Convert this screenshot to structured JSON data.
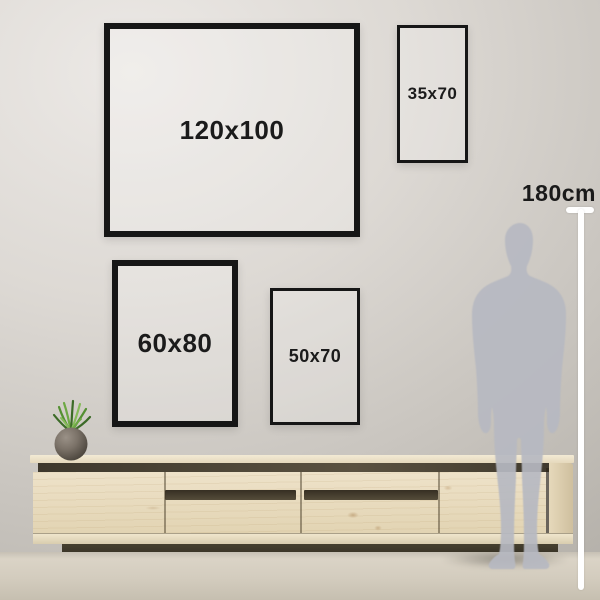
{
  "scene": {
    "description": "wall-art size comparison guide",
    "frames": [
      {
        "label": "120x100"
      },
      {
        "label": "35x70"
      },
      {
        "label": "60x80"
      },
      {
        "label": "50x70"
      }
    ],
    "measurement": {
      "height_label": "180cm"
    },
    "icons": {
      "person": "person-silhouette",
      "measure": "height-measure-line",
      "plant": "potted-plant",
      "furniture": "wooden-sideboard"
    },
    "colors": {
      "frame_border": "#161616",
      "label_text": "#1b1b1b",
      "wall_light": "#ece9e6",
      "wall_dark": "#b1ada6",
      "wood_light": "#eee2c9",
      "wood_dark_recess": "#3e382c",
      "plinth": "#2d2820",
      "floor": "#d3ccbe",
      "silhouette": "#b6b9c1",
      "measure_line": "#ffffff",
      "plant_green": "#549032",
      "pot_gray": "#776e63"
    }
  }
}
